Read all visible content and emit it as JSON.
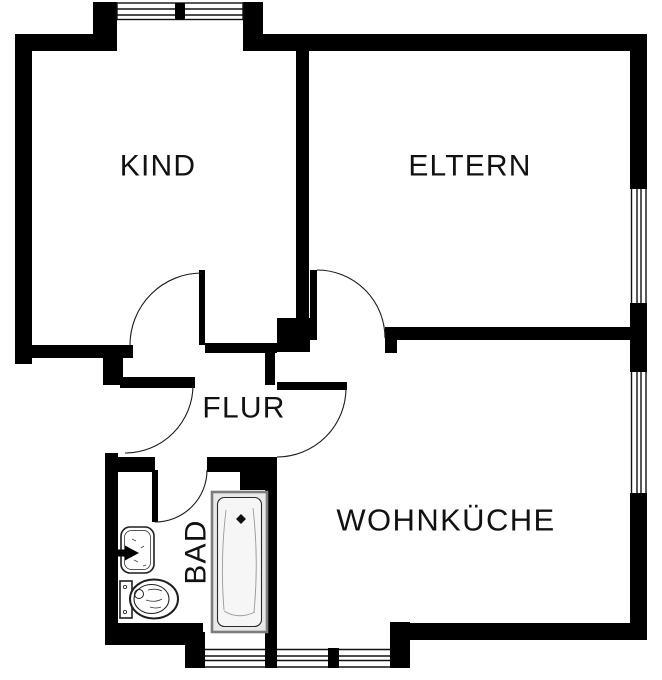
{
  "plan": {
    "type": "floorplan",
    "rooms": {
      "kind": {
        "label": "KIND"
      },
      "eltern": {
        "label": "ELTERN"
      },
      "flur": {
        "label": "FLUR"
      },
      "bad": {
        "label": "BAD"
      },
      "wohnkueche": {
        "label": "WOHNKÜCHE"
      }
    },
    "fixtures": {
      "bathtub": "bathtub-icon",
      "washbasin": "washbasin-icon",
      "toilet": "toilet-icon"
    },
    "features": {
      "windows": 5,
      "doors": 5,
      "entry_door": "left wall into hallway"
    }
  },
  "colors": {
    "wall": "#000000",
    "background": "#ffffff",
    "door_arc": "#1a1a1a",
    "fixture_stroke": "#1f1f1f",
    "tub_fill": "#e9e9e9",
    "tub_inner": "#f6f6f6",
    "tub_border": "#7d7d7d",
    "window_line": "#111111"
  }
}
